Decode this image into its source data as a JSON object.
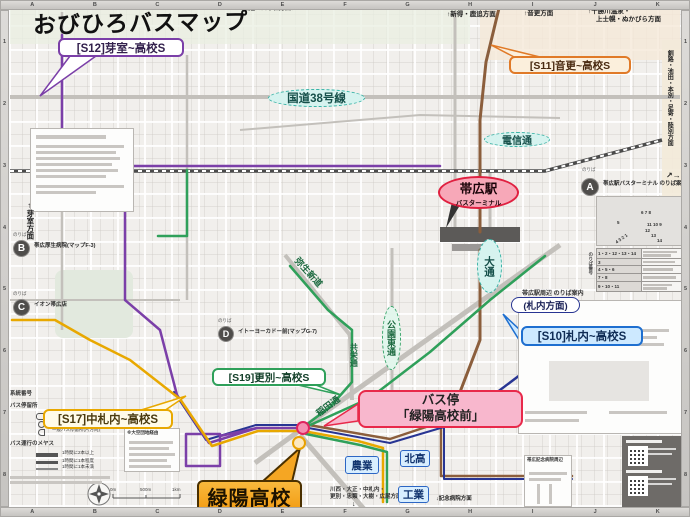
{
  "title": "おびひろバスマップ",
  "frame": {
    "cols": [
      "A",
      "B",
      "C",
      "D",
      "E",
      "F",
      "G",
      "H",
      "I",
      "J",
      "K"
    ],
    "rows": [
      "1",
      "2",
      "3",
      "4",
      "5",
      "6",
      "7",
      "8"
    ]
  },
  "routes": {
    "s12": {
      "label": "[S12]芽室~高校S",
      "color": "#7B3FA8"
    },
    "s11": {
      "label": "[S11]音更~高校S",
      "color": "#E07A28"
    },
    "s10": {
      "label": "[S10]札内~高校S",
      "color": "#1E6FD0"
    },
    "s19": {
      "label": "[S19]更別~高校S",
      "color": "#2FA05A"
    },
    "s17": {
      "label": "[S17]中札内~高校S",
      "color": "#E8A800"
    }
  },
  "callouts": {
    "bus_stop_line1": "バス停",
    "bus_stop_line2": "「緑陽高校前」",
    "school": "緑陽高校",
    "satsunai": "(札内方面)",
    "nogyo": "農業",
    "hokko": "北高",
    "kogyo": "工業"
  },
  "roads": {
    "route38": "国道38号線",
    "denshin": "電信通",
    "odori": "大通",
    "yayoi": "弥生新道",
    "koen": "公園東通",
    "kyoei": "共栄通",
    "inada": "稲田通"
  },
  "station": {
    "name": "帯広駅",
    "sub": "バスターミナル"
  },
  "directions": {
    "takushoku": "拓殖バス本社方面↑",
    "shintoku": "↑新得・鹿追方面",
    "otofuke": "↑音更方面",
    "tokachi1": "↑十勝川温泉・",
    "tokachi2": "上士幌・ぬかびら方面",
    "memuro": "←芽室方面",
    "kushiro": "釧路・池田・本別・足寄・陸別方面",
    "kushiro_arrows": "↗→",
    "kawanishi1": "川西・大正・中札内・",
    "kawanishi2": "更別・忠類・大樹・広尾方面",
    "kawanishi_arrow": "↓",
    "kinen": "↓記念病院方面"
  },
  "noriba": {
    "prefix": "のりば",
    "a_letter": "A",
    "a_label": "帯広駅バスターミナル のりば案内",
    "b_letter": "B",
    "b_label": "帯広厚生病院(マップF-3)",
    "c_letter": "C",
    "c_label": "イオン帯広店",
    "d_letter": "D",
    "d_label": "イトーヨーカドー前(マップG-7)"
  },
  "terminal_panel": {
    "col_label": "のりば番号",
    "rows": [
      "1・2・12・13・14",
      "3",
      "4・5・6",
      "7・8",
      "9・10・11"
    ],
    "bays": {
      "top": "6 7 8",
      "left": "5",
      "r1": "11 10 9",
      "r2": "12",
      "r3": "13",
      "r4": "14",
      "bottom": "4 3 2 1"
    }
  },
  "panels": {
    "shuhen": "帯広駅周辺 のりば案内",
    "kinen_area": "帯広記念病院周辺",
    "ozora": "※大空団地経由"
  },
  "legend": {
    "keito": "系統番号",
    "teiryujo": "バス停留所",
    "rows": [
      "起終点バス停留所",
      "一般バス停留所",
      "一般バス停留所(片方向)"
    ],
    "unko": "バス運行のメヤス",
    "unko_rows": [
      "1時間に2本以上",
      "1時間に1本程度",
      "1時間に1本未満"
    ],
    "scale": [
      "0m",
      "500m",
      "1km"
    ]
  },
  "palette": {
    "lens_fill": "#D6F3EF",
    "lens_border": "#39b3a6",
    "station_fill": "#F7A8B8",
    "station_border": "#E02040",
    "busstop_fill": "#F8B7CD",
    "busstop_border": "#E8294A",
    "school_fill": "#F29B13",
    "navy": "#283593",
    "brown": "#8B5E3C",
    "gold": "#E8A800",
    "green": "#2FA05A",
    "purple": "#7B3FA8",
    "blue": "#1E6FD0"
  }
}
